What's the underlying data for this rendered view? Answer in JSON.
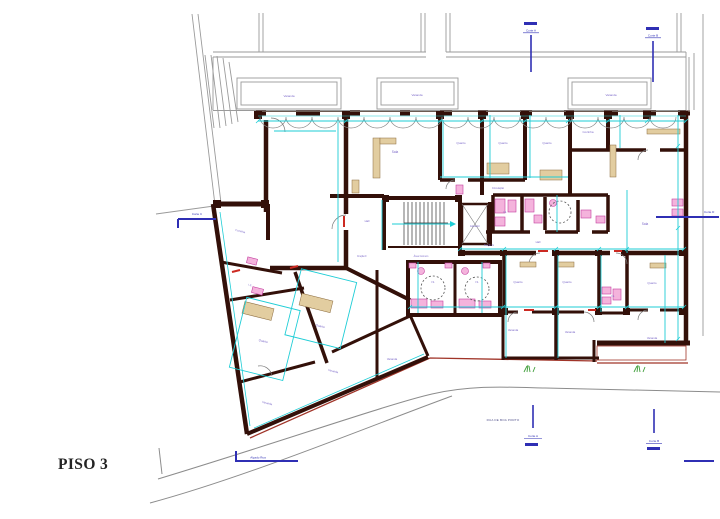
{
  "title": {
    "floor_label": "PISO 3"
  },
  "street": {
    "name": "RUA DE BOA PORTO"
  },
  "plan": {
    "markers": [
      {
        "id": "section-top-1",
        "label": "Corte A"
      },
      {
        "id": "section-top-2",
        "label": "Corte B"
      },
      {
        "id": "section-left",
        "label": "Corte C"
      },
      {
        "id": "elevation-street",
        "label": "Alçado Rua"
      },
      {
        "id": "section-bottom-1",
        "label": "Corte A"
      },
      {
        "id": "section-bottom-2",
        "label": "Corte B"
      },
      {
        "id": "section-right",
        "label": "Corte D"
      }
    ],
    "room_labels": [
      {
        "text": "Varanda",
        "x": 289,
        "y": 97,
        "s": 3
      },
      {
        "text": "Varanda",
        "x": 417,
        "y": 96,
        "s": 3
      },
      {
        "text": "Varanda",
        "x": 611,
        "y": 96,
        "s": 3
      },
      {
        "text": "Sala",
        "x": 395,
        "y": 153,
        "s": 3.2
      },
      {
        "text": "Quarto",
        "x": 461,
        "y": 144,
        "s": 3
      },
      {
        "text": "Quarto",
        "x": 503,
        "y": 144,
        "s": 3
      },
      {
        "text": "Quarto",
        "x": 547,
        "y": 144,
        "s": 3
      },
      {
        "text": "Cozinha",
        "x": 588,
        "y": 133,
        "s": 3
      },
      {
        "text": "Circulação",
        "x": 498,
        "y": 189,
        "s": 2.6
      },
      {
        "text": "Hall",
        "x": 367,
        "y": 222,
        "s": 2.8
      },
      {
        "text": "Hall",
        "x": 538,
        "y": 243,
        "s": 2.8
      },
      {
        "text": "Elevador",
        "x": 475,
        "y": 227,
        "s": 2.4
      },
      {
        "text": "Fração F",
        "x": 362,
        "y": 257,
        "s": 2.4
      },
      {
        "text": "Fração G",
        "x": 489,
        "y": 246,
        "s": 2.4
      },
      {
        "text": "Área Comum",
        "x": 421,
        "y": 257,
        "s": 2.5
      },
      {
        "text": "I.S.",
        "x": 433,
        "y": 283,
        "s": 2.6
      },
      {
        "text": "I.S.",
        "x": 477,
        "y": 283,
        "s": 2.6
      },
      {
        "text": "I.S.",
        "x": 505,
        "y": 213,
        "s": 2.6
      },
      {
        "text": "I.S.",
        "x": 613,
        "y": 297,
        "s": 2.6
      },
      {
        "text": "Sala",
        "x": 645,
        "y": 225,
        "s": 3.2
      },
      {
        "text": "Quarto",
        "x": 518,
        "y": 283,
        "s": 3
      },
      {
        "text": "Quarto",
        "x": 567,
        "y": 283,
        "s": 3
      },
      {
        "text": "Quarto",
        "x": 652,
        "y": 284,
        "s": 3
      },
      {
        "text": "Varanda",
        "x": 513,
        "y": 331,
        "s": 2.8
      },
      {
        "text": "Varanda",
        "x": 570,
        "y": 333,
        "s": 2.8
      },
      {
        "text": "Varanda",
        "x": 652,
        "y": 339,
        "s": 2.8
      },
      {
        "text": "Varanda",
        "x": 392,
        "y": 360,
        "s": 2.8
      },
      {
        "text": "Cozinha",
        "x": 240,
        "y": 232,
        "s": 2.8,
        "r": 14
      },
      {
        "text": "I.S.",
        "x": 250,
        "y": 286,
        "s": 2.6,
        "r": 14
      },
      {
        "text": "Quarto",
        "x": 263,
        "y": 342,
        "s": 3,
        "r": 14
      },
      {
        "text": "Quarto",
        "x": 320,
        "y": 327,
        "s": 3,
        "r": 14
      },
      {
        "text": "Varanda",
        "x": 267,
        "y": 404,
        "s": 2.8,
        "r": 14
      },
      {
        "text": "Varanda",
        "x": 333,
        "y": 372,
        "s": 2.8,
        "r": 14
      }
    ]
  },
  "colors": {
    "wall": "#331009",
    "dimension": "#1ecdd6",
    "fixture_fill": "#f4b3dc",
    "fixture_stroke": "#c33f9f",
    "marker_blue": "#2f2fb4",
    "context_gray": "#9a9a9a",
    "label_purple": "#7b68c8",
    "street_gray": "#8c8c8c",
    "accent_red": "#a03428",
    "door_red": "#cc2a22",
    "planting_green": "#3f9e3a",
    "furniture_tan": "#e2cda0"
  }
}
